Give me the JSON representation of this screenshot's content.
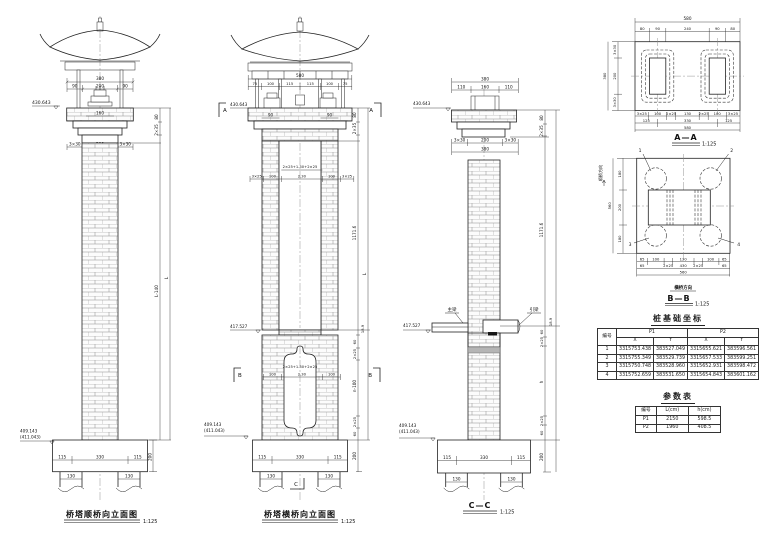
{
  "common": {
    "scale": "1:125",
    "elev_top": "430.643",
    "elev_beam": "417.527",
    "elev_base": "409.143",
    "elev_base_alt": "(411.043)",
    "d60": "60",
    "d65": "65",
    "d75": "75",
    "d80": "80",
    "d90": "90",
    "d100": "100",
    "d110": "110",
    "d115": "115",
    "d125": "125",
    "d130": "130",
    "d160": "160",
    "d180": "180",
    "d200": "200",
    "d240": "240",
    "d330": "330",
    "d380": "380",
    "d430": "430",
    "d560": "560",
    "d580": "580",
    "d230": "2.30",
    "d3x30": "3×30",
    "d3x25": "3×25",
    "d2x25": "2×25",
    "d2x35": "2×35",
    "d18_9": "18.9",
    "dn100": "n-100",
    "dL": "L",
    "dh": "h",
    "dL140": "L-140",
    "d1171": "1171.6"
  },
  "views": {
    "front": {
      "title": "桥塔顺桥向立面图"
    },
    "side": {
      "title": "桥塔横桥向立面图",
      "formula": "2×25+1.30+2×25",
      "marker_a": "A",
      "marker_b": "B",
      "marker_c": "C"
    },
    "cc": {
      "title": "C—C",
      "label_main_beam": "主梁",
      "label_approach_beam": "引梁"
    },
    "aa": {
      "title": "A—A"
    },
    "bb": {
      "title": "B—B",
      "axis_along": "顺桥方向",
      "axis_across": "横桥方向",
      "pile1": "1",
      "pile2": "2",
      "pile3": "3",
      "pile4": "4"
    }
  },
  "tables": {
    "coords": {
      "heading": "桩基础坐标",
      "col_id": "编号",
      "col_p1": "P1",
      "col_p2": "P2",
      "col_x": "X",
      "col_y": "Y",
      "rows": [
        {
          "id": "1",
          "p1x": "3315753.438",
          "p1y": "383527.049",
          "p2x": "3315655.621",
          "p2y": "383596.561"
        },
        {
          "id": "2",
          "p1x": "3315755.349",
          "p1y": "383529.739",
          "p2x": "3315657.533",
          "p2y": "383599.251"
        },
        {
          "id": "3",
          "p1x": "3315750.748",
          "p1y": "383528.960",
          "p2x": "3315652.931",
          "p2y": "383598.472"
        },
        {
          "id": "4",
          "p1x": "3315752.659",
          "p1y": "383531.650",
          "p2x": "3315654.843",
          "p2y": "383601.162"
        }
      ]
    },
    "params": {
      "heading": "参数表",
      "col_id": "编号",
      "col_l": "L(cm)",
      "col_h": "h(cm)",
      "rows": [
        {
          "id": "P1",
          "l": "2150",
          "h": "598.5"
        },
        {
          "id": "P2",
          "l": "1960",
          "h": "408.5"
        }
      ]
    }
  }
}
